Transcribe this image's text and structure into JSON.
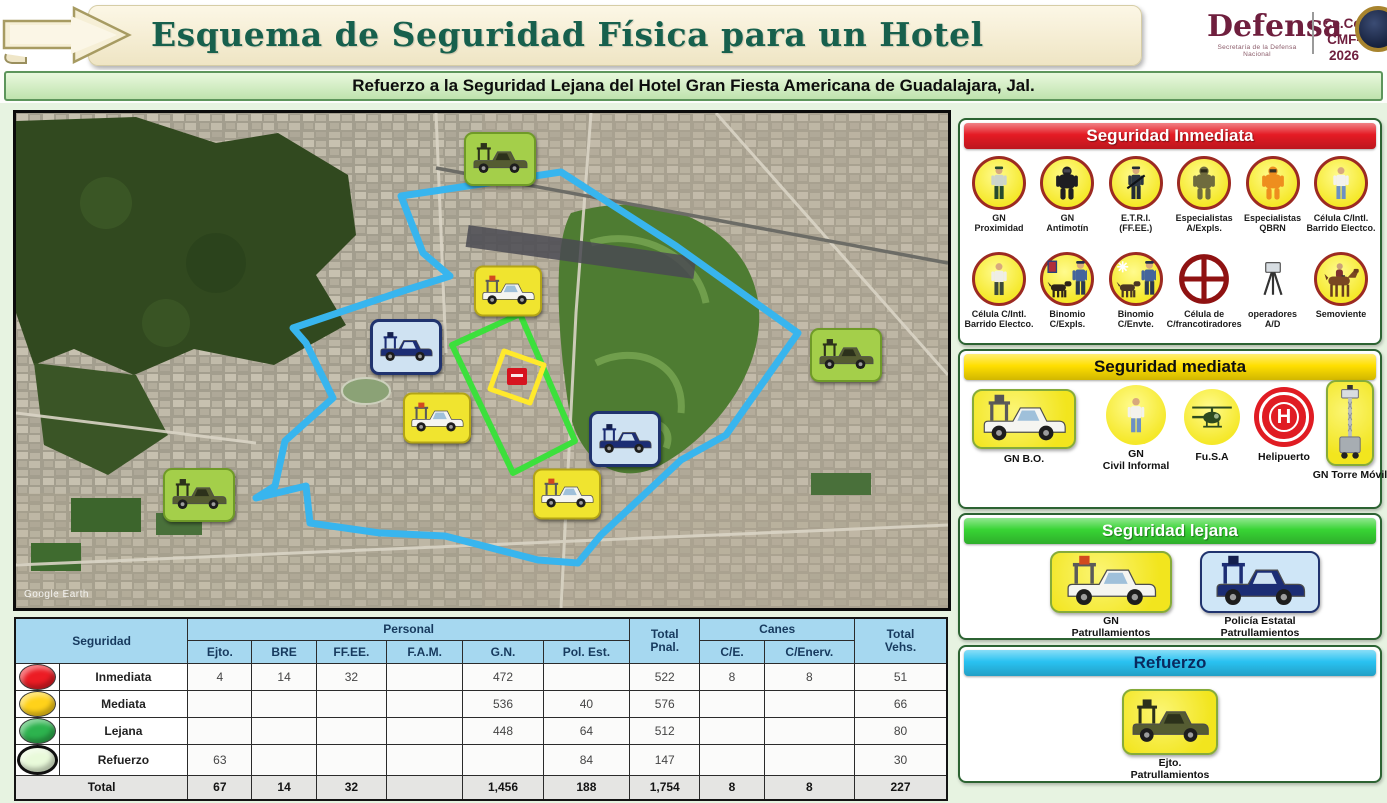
{
  "header": {
    "title": "Esquema de Seguridad Física para un Hotel",
    "brand": "Defensa",
    "brand_sub": "Secretaría de la Defensa Nacional",
    "org_id": "Ce.Co.\nCMF-2026"
  },
  "subtitle": "Refuerzo a la Seguridad Lejana del Hotel Gran Fiesta Americana de Guadalajara, Jal.",
  "map": {
    "watermark": "Google Earth",
    "zone_colors": {
      "outer_perimeter": "#38b5ee",
      "inner_perimeter": "#3ce03c",
      "hotel_block": "#ffe92c",
      "hotel_marker": "#d6131f"
    },
    "markers": [
      {
        "id": "ejto-patrol-north",
        "kind": "military"
      },
      {
        "id": "ejto-patrol-east",
        "kind": "military"
      },
      {
        "id": "ejto-patrol-southwest",
        "kind": "military"
      },
      {
        "id": "gn-patrol-north",
        "kind": "gn"
      },
      {
        "id": "gn-patrol-west",
        "kind": "gn"
      },
      {
        "id": "gn-patrol-south",
        "kind": "gn"
      },
      {
        "id": "police-patrol-northwest",
        "kind": "police"
      },
      {
        "id": "police-patrol-southeast",
        "kind": "police"
      }
    ]
  },
  "panels": {
    "inmediata": {
      "title": "Seguridad Inmediata",
      "header_color": "#e51b24",
      "items": [
        "GN\nProximidad",
        "GN\nAntimotín",
        "E.T.R.I.\n(FF.EE.)",
        "Especialistas\nA/Expls.",
        "Especialistas\nQBRN",
        "Célula C/Intl.\nBarrido Electco.",
        "Célula C/Intl.\nBarrido Electco.",
        "Binomio\nC/Expls.",
        "Binomio\nC/Envte.",
        "Célula de\nC/francotiradores",
        "operadores\nA/D",
        "Semoviente"
      ]
    },
    "mediata": {
      "title": "Seguridad mediata",
      "header_color": "#ffdf00",
      "items": [
        "GN B.O.",
        "GN\nCivil Informal",
        "Fu.S.A",
        "Helipuerto",
        "GN Torre Móvil"
      ]
    },
    "lejana": {
      "title": "Seguridad lejana",
      "header_color": "#38d434",
      "items": [
        "GN\nPatrullamientos",
        "Policía Estatal\nPatrullamientos"
      ]
    },
    "refuerzo": {
      "title": "Refuerzo",
      "header_color": "#29c2f1",
      "items": [
        "Ejto.\nPatrullamientos"
      ]
    }
  },
  "table": {
    "headers": {
      "seguridad": "Seguridad",
      "personal": "Personal",
      "total_pnal": "Total\nPnal.",
      "canes": "Canes",
      "total_vehs": "Total\nVehs.",
      "personal_cols": [
        "Ejto.",
        "BRE",
        "FF.EE.",
        "F.A.M.",
        "G.N.",
        "Pol. Est."
      ],
      "canes_cols": [
        "C/E.",
        "C/Enerv."
      ]
    },
    "rows": [
      {
        "label": "Inmediata",
        "dot_color": "#ec1c24",
        "cells": [
          "4",
          "14",
          "32",
          "",
          "472",
          "",
          "522",
          "8",
          "8",
          "51"
        ]
      },
      {
        "label": "Mediata",
        "dot_color": "#ffd21a",
        "cells": [
          "",
          "",
          "",
          "",
          "536",
          "40",
          "576",
          "",
          "",
          "66"
        ]
      },
      {
        "label": "Lejana",
        "dot_color": "#2db34e",
        "cells": [
          "",
          "",
          "",
          "",
          "448",
          "64",
          "512",
          "",
          "",
          "80"
        ]
      },
      {
        "label": "Refuerzo",
        "dot_color": "#e9fada",
        "cells": [
          "63",
          "",
          "",
          "",
          "",
          "84",
          "147",
          "",
          "",
          "30"
        ]
      }
    ],
    "total_row": {
      "label": "Total",
      "cells": [
        "67",
        "14",
        "32",
        "",
        "1,456",
        "188",
        "1,754",
        "8",
        "8",
        "227"
      ]
    }
  }
}
